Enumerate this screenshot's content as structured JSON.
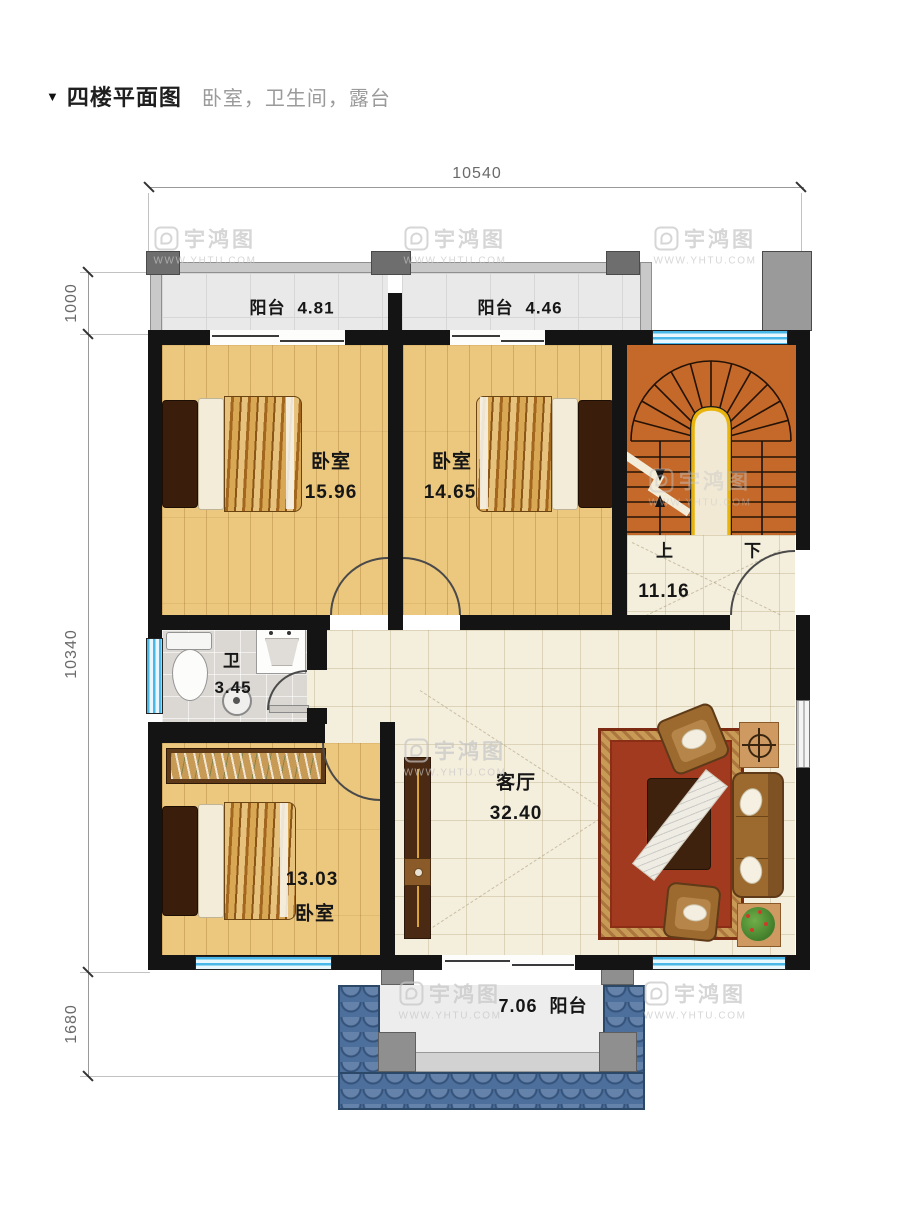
{
  "title": {
    "marker": "▼",
    "heading": "四楼平面图",
    "subtitle": "卧室，卫生间，露台"
  },
  "dimensions": {
    "top": "10540",
    "left_upper": "1000",
    "left_middle": "10340",
    "left_lower": "1680"
  },
  "watermark": {
    "name": "宇鸿图",
    "site": "WWW.YHTU.COM"
  },
  "rooms": {
    "balcony_top_left": {
      "label": "阳台",
      "area": "4.81"
    },
    "balcony_top_right": {
      "label": "阳台",
      "area": "4.46"
    },
    "bedroom_a": {
      "label": "卧室",
      "area": "15.96"
    },
    "bedroom_b": {
      "label": "卧室",
      "area": "14.65"
    },
    "stair_hall": {
      "area": "11.16",
      "up_label": "上",
      "down_label": "下"
    },
    "bathroom": {
      "label": "卫",
      "area": "3.45"
    },
    "bedroom_c": {
      "label": "卧室",
      "area": "13.03"
    },
    "living_room": {
      "label": "客厅",
      "area": "32.40"
    },
    "balcony_bottom": {
      "label": "阳台",
      "area": "7.06"
    }
  },
  "colors": {
    "wall": "#141414",
    "window": "#49b7e8",
    "wood_floor": "#ecc87f",
    "tile": "#f4eedd",
    "stairs": "#c4692a",
    "terrace": "#4c6f9c",
    "carpet": "#a23a20"
  }
}
